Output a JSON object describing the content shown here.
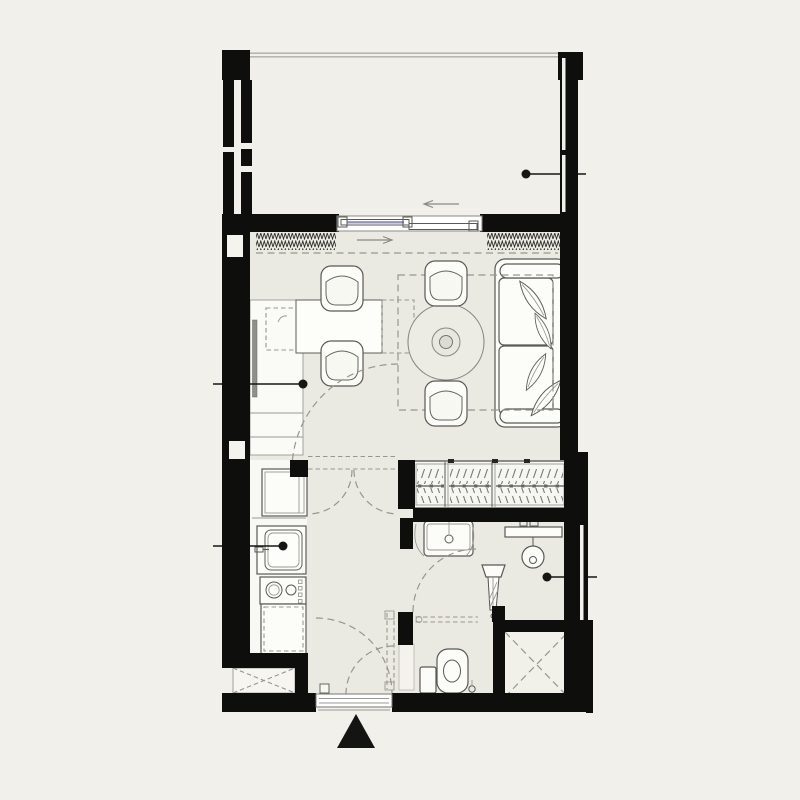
{
  "page": {
    "background": "#f2f0ea",
    "content_type": "architectural floor plan of a studio apartment, line drawing, no text labels"
  },
  "colors": {
    "page-bg": "#f2f0ea",
    "wall": "#0e0e0d",
    "floor": "#ebeae2",
    "balcony-floor": "#f0efe9",
    "kitchen-floor": "#f8f8f4",
    "fixture-fill": "#fcfcf9",
    "fixture-stroke": "#595955",
    "dash": "#98968f",
    "marker": "#161614",
    "railing": "#b8b6b0",
    "glass": "#9095c2",
    "arrow": "#8a8a86"
  },
  "plan": {
    "rooms_depicted": [
      "balcony",
      "living-room",
      "kitchen",
      "hallway",
      "bathroom",
      "wc",
      "shower"
    ],
    "callout_markers": [
      {
        "id": "balcony-marker",
        "leader_direction": "right"
      },
      {
        "id": "living-room-marker",
        "leader_direction": "left"
      },
      {
        "id": "kitchen-sink-marker",
        "leader_direction": "left"
      },
      {
        "id": "shower-marker",
        "leader_direction": "right"
      }
    ],
    "symbols_depicted": [
      "balcony-railing",
      "sliding-glass-door",
      "slide-direction-arrows",
      "curtain-hatch",
      "dining-table",
      "dining-chair-x4",
      "round-table",
      "sofa",
      "leaf-cushion-x4",
      "sofa-bed-dashed-outline",
      "tv-panel",
      "counter-desk",
      "fold-table-dashed",
      "fridge",
      "kitchen-sink",
      "cooktop-2-burner",
      "base-cabinet-dashed",
      "wardrobe-with-hangers",
      "washbasin",
      "shower-mixer-bar",
      "shower-head",
      "glass-door-leaf",
      "toilet",
      "floor-drain",
      "service-shaft-x-mark-x2",
      "door-swing-arc-x5",
      "pocket-door-dashes",
      "entry-threshold",
      "entry-arrow-triangle"
    ]
  }
}
